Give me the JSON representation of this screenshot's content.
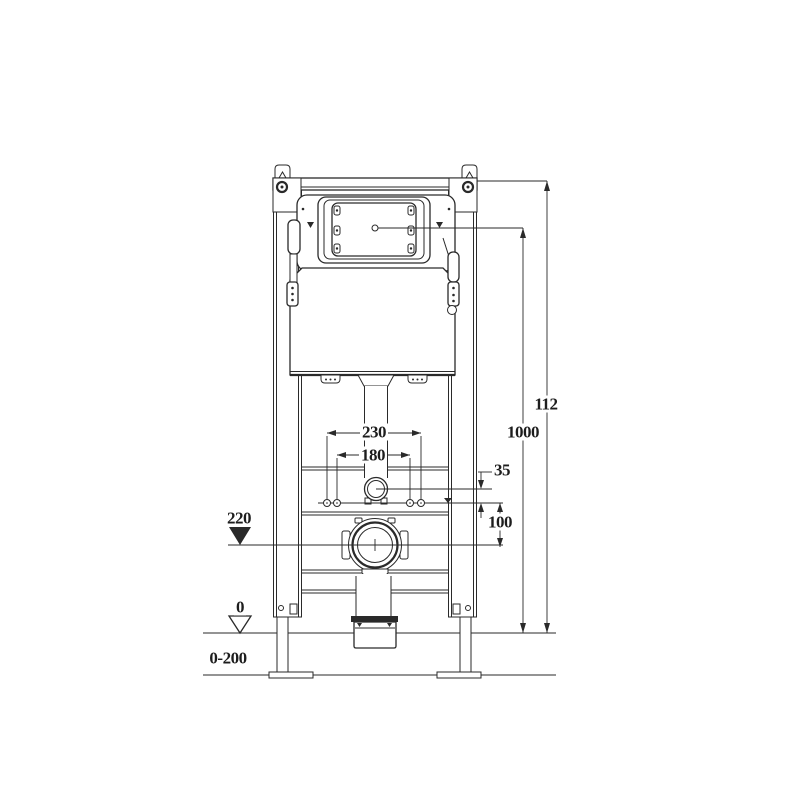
{
  "drawing": {
    "description": "wall-hung-toilet-concealed-cistern-frame-technical-drawing",
    "background_color": "#ffffff",
    "line_color": "#2a2a2a",
    "dimensions": {
      "frame_height": "112",
      "flush_plate_center_height": "1000",
      "outer_bolt_spacing": "230",
      "inner_bolt_spacing": "180",
      "inlet_offset": "35",
      "outlet_drop": "100",
      "waste_outlet_height": "220",
      "floor_zero_level": "0",
      "floor_adjustment_range": "0-200"
    }
  }
}
